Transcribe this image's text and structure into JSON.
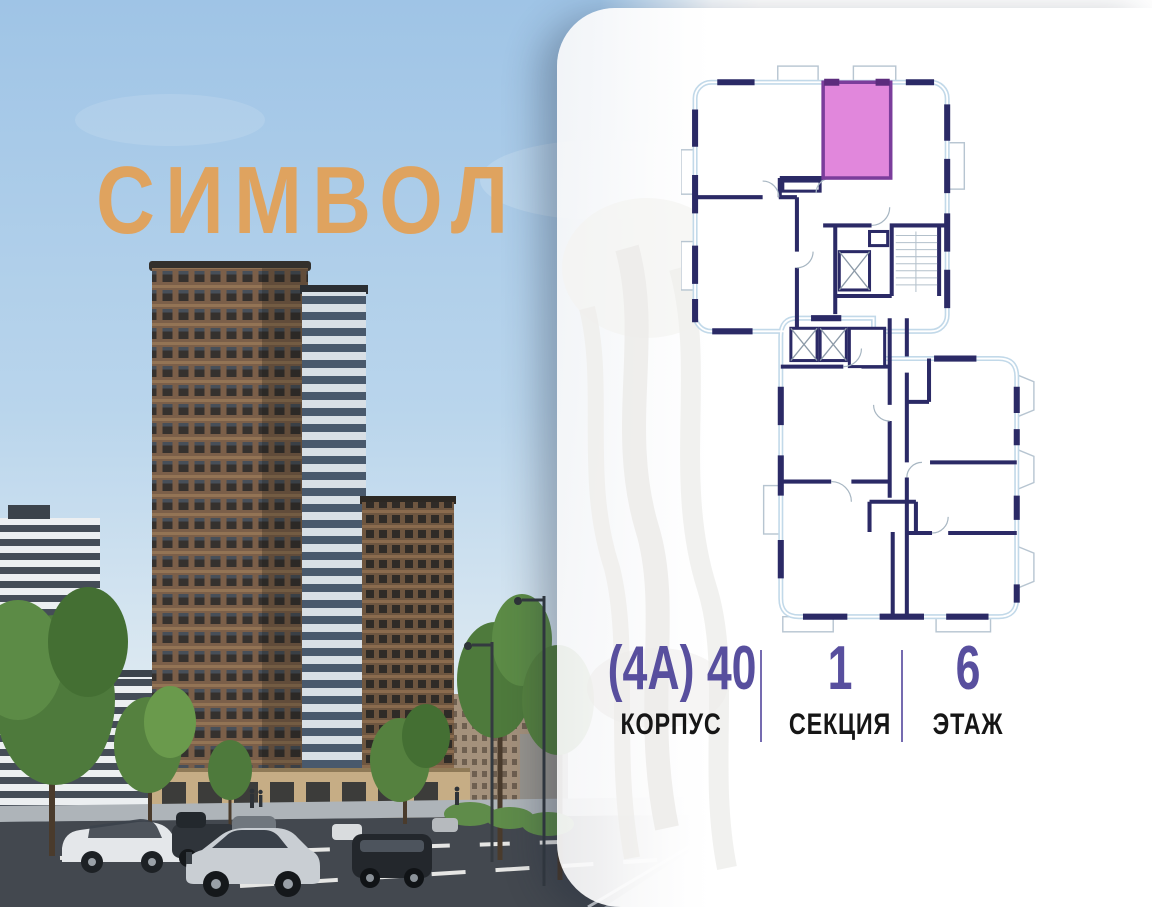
{
  "brand": {
    "logo_text": "СИМВОЛ",
    "logo_color": "#DFA35F"
  },
  "photo": {
    "alt": "street-level render of brown residential towers, trees, road with cars"
  },
  "floorplan": {
    "alt": "section floor plan with one highlighted studio unit at top",
    "colors": {
      "highlight_fill": "#E187DC",
      "highlight_border": "#7B3D9B",
      "walls": "#2B2A66",
      "outer_wall": "#C2D9E9"
    }
  },
  "info": {
    "value_color": "#584F9E",
    "items": [
      {
        "value": "(4А) 40",
        "label": "КОРПУС"
      },
      {
        "value": "1",
        "label": "СЕКЦИЯ"
      },
      {
        "value": "6",
        "label": "ЭТАЖ"
      }
    ]
  }
}
